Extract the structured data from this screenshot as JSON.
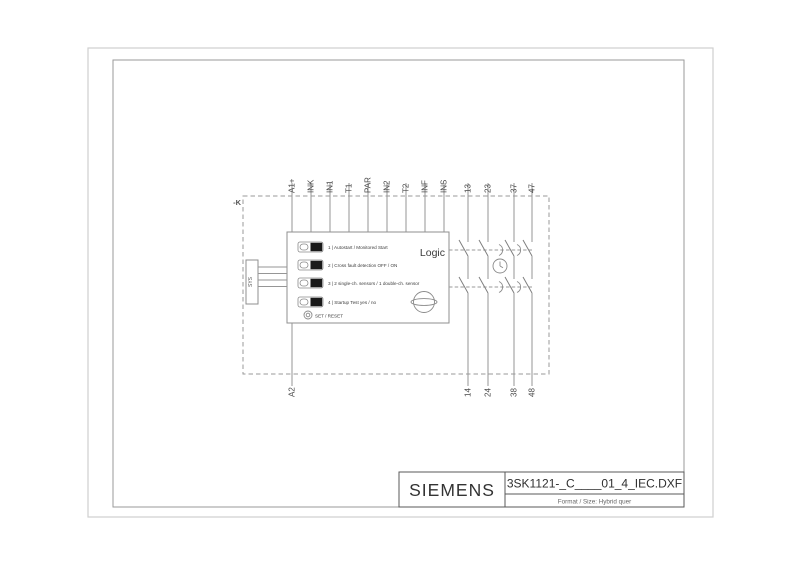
{
  "title_block": {
    "brand": "SIEMENS",
    "filename": "3SK1121-_C____01_4_IEC.DXF",
    "format_label": "Format / Size: Hybrid quer"
  },
  "diagram": {
    "device_tag": "-K",
    "logic_label": "Logic",
    "connector_label": "SYS",
    "set_reset_label": "SET / RESET",
    "dip_switch_labels": [
      "1 | Autostart / Monitored Start",
      "2 | Cross fault detection OFF / ON",
      "3 | 2 single-ch. sensors / 1 double-ch. sensor",
      "4 | Startup Test yes / no"
    ],
    "terminals_top": [
      "A1+",
      "INK",
      "IN1",
      "T1",
      "PAR",
      "IN2",
      "T2",
      "INF",
      "INS",
      "13",
      "23",
      "37",
      "47"
    ],
    "terminals_bottom": [
      "A2",
      "14",
      "24",
      "38",
      "48"
    ],
    "colors": {
      "line_gray": "#969696",
      "text_gray": "#4a4a4a",
      "switch_black": "#1a1a1a"
    }
  }
}
